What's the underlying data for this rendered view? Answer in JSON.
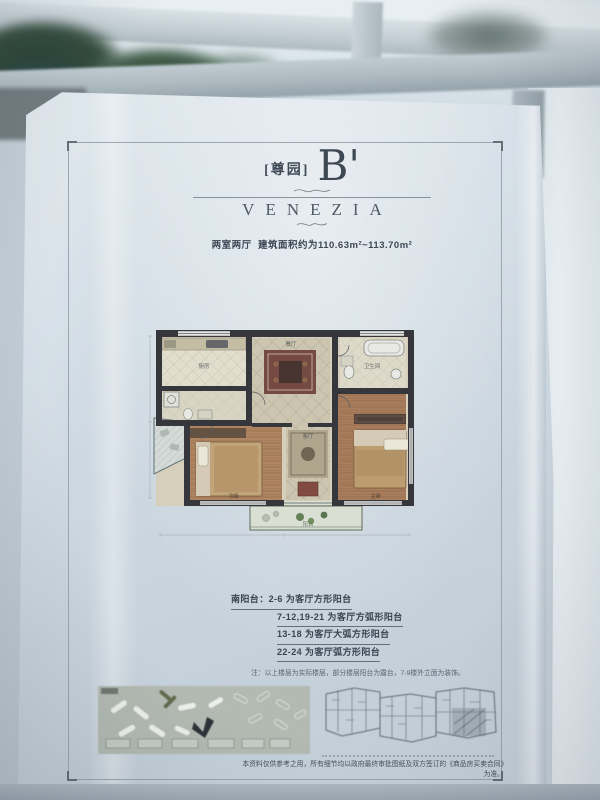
{
  "poster": {
    "title": {
      "tag": "[尊园]",
      "unit": "B'",
      "brand": "VENEZIA",
      "subtitle_rooms": "两室两厅",
      "subtitle_area": "建筑面积约为110.63m²~113.70m²"
    },
    "floor_plan": {
      "rooms": {
        "kitchen": "厨房",
        "dining": "餐厅",
        "bathroom": "卫生间",
        "master_bedroom": "主卧",
        "second_bedroom": "次卧",
        "living_room": "客厅",
        "balcony": "阳台"
      }
    },
    "legend": {
      "lines": [
        "南阳台：2-6 为客厅方形阳台",
        "7-12,19-21 为客厅方弧形阳台",
        "13-18 为客厅大弧方形阳台",
        "22-24 为客厅弧方形阳台"
      ],
      "note": "注：以上楼层为实际楼层，部分楼层阳台为露台，7-9楼外立面为装饰。"
    },
    "disclaimer": "本资料仅供参考之用，所有细节均以政府最终审批图纸及双方签订的《商品房买卖合同》为准。",
    "colors": {
      "ink": "#2e3640",
      "wall": "#26262c",
      "wood_floor": "#a8744c",
      "rug": "#6e3c32",
      "plan_base": "#d8d0b8",
      "site_plan": "#b2b8ae",
      "poster_paper": "#d3dde5"
    }
  }
}
